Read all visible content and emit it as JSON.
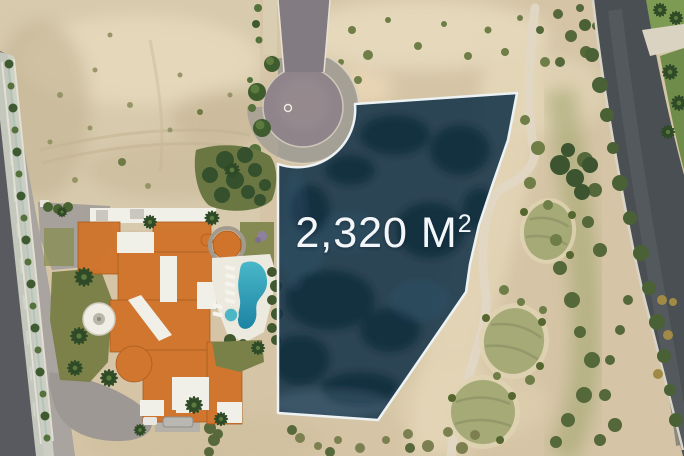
{
  "lot_overlay": {
    "area_label": "2,320 M",
    "area_superscript": "2",
    "text_color": "#f3f7f9",
    "fill_color": "#143349",
    "border_color": "#edf3f5"
  },
  "terrain_colors": {
    "sand": "#d5c5a6",
    "desert_lot": "#d8cbad",
    "street": "#595a5f",
    "street_lane": "#a9a49f",
    "cul_de_sac": "#8f8489",
    "cul_de_sac_apron": "#a5a095",
    "motor_court": "#a6a19b",
    "driveway_apron": "#9d9894",
    "roof_tile": "#d0742c",
    "roof_white": "#f0efe8",
    "pool_water": "#2fa8bf",
    "pool_deep": "#1d83a4",
    "lawn": "#7b8149",
    "palm_green": "#2f4a26",
    "scrub_green": "#5c6d38",
    "golf_green": "#a5aa77",
    "golf_road": "#4a4f54",
    "path": "#e0d7c4",
    "curb": "#d8d4c8"
  }
}
